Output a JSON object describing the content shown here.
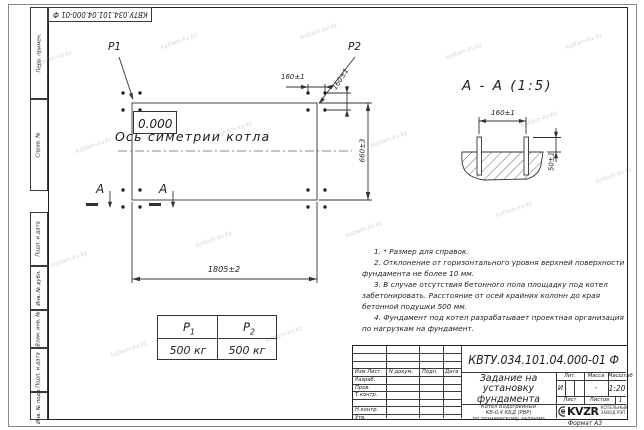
{
  "watermark": {
    "text": "kotlam-kv.kz"
  },
  "frame": {
    "doc_number_top": "КВТУ.034.101.04.000-01 Ф",
    "sidebar_labels": [
      "Перв. примен.",
      "Справ. №",
      "Подп. и дата",
      "Инв. № дубл.",
      "Взам. инв. №",
      "Подп. и дата",
      "Инв. № подл."
    ]
  },
  "plan": {
    "p1_label": "P1",
    "p2_label": "P2",
    "zero_level": "0.000",
    "axis_label": "Ось симетрии котла",
    "dim_160_cols": "160±1",
    "dim_160_rows": "160±1",
    "dim_660": "660±3",
    "dim_1805": "1805±2",
    "section_letter_left": "А",
    "section_letter_right": "А"
  },
  "section": {
    "title": "А - А (1:5)",
    "dim_160": "160±1",
    "dim_50": "50±1"
  },
  "load_table": {
    "col1_base": "P",
    "col1_sub": "1",
    "col2_base": "P",
    "col2_sub": "2",
    "col1_value": "500 кг",
    "col2_value": "500 кг"
  },
  "notes": {
    "items": [
      "1. * Размер для справок.",
      "2. Отклонение от горизонтального уровня верхней поверхности фундамента не более 10 мм.",
      "3. В случае отсутствия бетонного пола площадку под котел забетонировать. Расстояние от осей крайних колонн до края бетонной подушки 500 мм.",
      "4. Фундамент под котел разрабатывает проектная организация по нагрузкам на фундамент."
    ]
  },
  "title_block": {
    "doc_number": "КВТУ.034.101.04.000-01 Ф",
    "headers": {
      "izm": "Изм.Лист",
      "doc": "N докум.",
      "podp": "Подп.",
      "data": "Дата",
      "lit": "Лит.",
      "massa": "Масса",
      "masshtab": "Масштаб",
      "list": "Лист",
      "listov": "Листов"
    },
    "rows": [
      "Разраб.",
      "Пров.",
      "Т.контр.",
      "",
      "Н.контр.",
      "Утв."
    ],
    "title_line1": "Задание на",
    "title_line2": "установку",
    "title_line3": "фундамента",
    "subtitle_line1": "Котел Водогрейный",
    "subtitle_line2": "КВ-0,4 КБД (РВР)",
    "subtitle_line3": "по техническому заданию",
    "lit_value": "И",
    "massa_value": "-",
    "masshtab_value": "1:20",
    "listov_value": "1",
    "logo_text": "KVZR",
    "logo_caption1": "КОТЕЛЬНЫЙ",
    "logo_caption2": "ЗАВОД РЭП",
    "format_label": "Формат А3"
  }
}
